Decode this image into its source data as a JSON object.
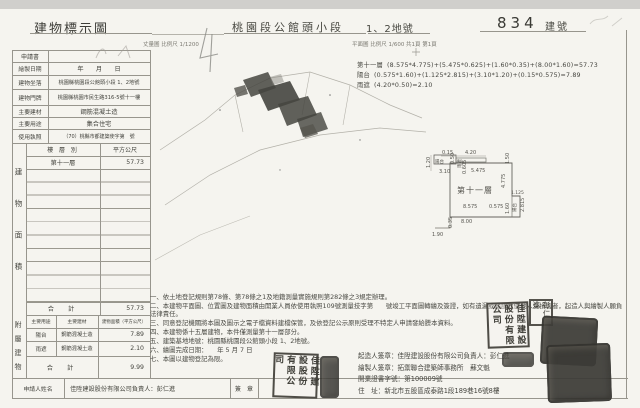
{
  "header": {
    "title": "建物標示圖",
    "section": "桃園段公館頭小段",
    "lot": "1、2地號",
    "building_no": "834",
    "building_no_label": "建號",
    "survey_scale": "丈量圖 比例尺 1/1200",
    "plan_scale": "平面圖 比例尺 1/600",
    "page_info": "共1頁 第1頁"
  },
  "form": {
    "rows": [
      {
        "label": "申請書",
        "value": ""
      },
      {
        "label": "繪製日期",
        "value": "年　　月　　日"
      },
      {
        "label": "建物坐落",
        "value": "桃園縣桃園段公館頭小段 1、2地號"
      },
      {
        "label": "建物門牌",
        "value": "桃園縣桃園市民生路316-5號十一樓"
      },
      {
        "label": "主要建材",
        "value": "鋼筋混凝土造"
      },
      {
        "label": "主要用途",
        "value": "集合住宅"
      },
      {
        "label": "使用執照",
        "value": "（70）桃縣市都建築使字第　號"
      }
    ]
  },
  "floor_table": {
    "side_label": "建物面積",
    "col_floor": "樓 層 別",
    "col_area": "平方公尺",
    "rows": [
      {
        "floor": "第十一層",
        "area": "57.73"
      }
    ],
    "total_label": "合　計",
    "total_area": "57.73"
  },
  "annex_table": {
    "side_label": "附屬建物",
    "col_use": "主要用途",
    "col_material": "主要建材",
    "col_area": "建物面積（平方公尺）",
    "rows": [
      {
        "use": "陽台",
        "material": "鋼筋混凝土造",
        "area": "7.89"
      },
      {
        "use": "雨遮",
        "material": "鋼筋混凝土造",
        "area": "2.10"
      }
    ],
    "total_label": "合　計",
    "total_area": "9.99"
  },
  "applicant": {
    "label": "申請人姓名",
    "value": "佳陞建設股份有限公司負責人：彭仁進",
    "sign_label": "簽　章"
  },
  "calculations": [
    {
      "label": "第十一層",
      "formula": "(8.575*4.775)+(5.475*0.625)+(1.60*0.35)+(8.00*1.60)=57.73"
    },
    {
      "label": "陽台",
      "formula": "(0.575*1.60)+(1.125*2.815)+(3.10*1.20)+(0.15*0.575)=7.89"
    },
    {
      "label": "雨遮",
      "formula": "(4.20*0.50)=2.10"
    }
  ],
  "floor_plan": {
    "dims": [
      "0.15",
      "4.20",
      "0.50",
      "雨遮",
      "1.20",
      "陽台",
      "3.10",
      "0.605",
      "5.475",
      "1.50",
      "4.775",
      "第十一層",
      "1.125",
      "8.575",
      "0.575",
      "2.815",
      "陽台",
      "1.60",
      "8.00",
      "0.35",
      "1.90"
    ]
  },
  "notes": [
    "一、依土地登記規則第78條、第78條之1及地籍測量實施規則第282條之3規定辦理。",
    "二、本建物平面圖、位置圖及建物面積由開業人員依使用執照109號測量技字第　　號竣工平面圖轉繪及簽證，如有遺漏或錯誤致使他人受損害者，起造人與繪製人願負法律責任。",
    "三、同意登記機關將本圖及圖示之電子檔資料建檔保管，及依登記公示原則受理不特定人申請發給謄本資料。",
    "四、本建物係十五層建物，本件僅測量第十一層部分。",
    "五、建築基地地號：桃園縣桃園段公館頭小段 1、2地號。",
    "六、繪圖完成日期：　　年 5 月 7 日",
    "七、本圖以建物登記為限。"
  ],
  "signature_block": {
    "lines": [
      "起造人簽章：佳陞建設股份有限公司負責人：彭仁進",
      "繪製人簽章：拓禦聯合建築師事務所　蘇文魁",
      "開業證書字號：第100009號",
      "住　址：新北市五股區成泰路1段189巷16號8樓"
    ]
  },
  "seals": {
    "company": "佳陞建設股份有限公司",
    "personal": "彭仁進"
  }
}
